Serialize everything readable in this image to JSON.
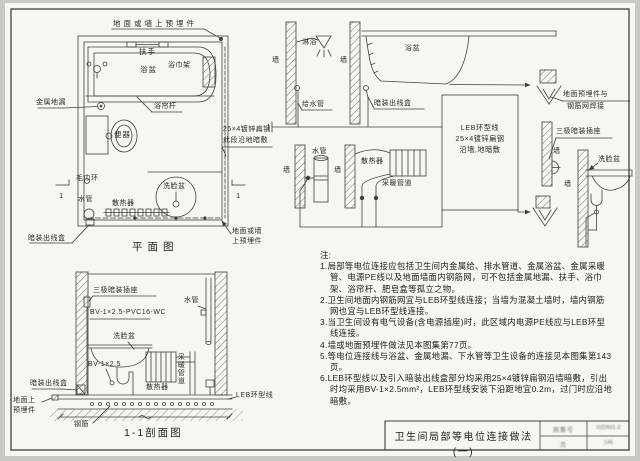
{
  "page": {
    "background": "#c9c9c7",
    "paper": "#f7f6f2",
    "line_color": "#41403b"
  },
  "plan": {
    "title": "平面图",
    "labels": {
      "embed_top": "地面或墙上预埋件",
      "handrail": "扶手",
      "tub": "浴盆",
      "towel_rack": "浴巾架",
      "floor_drain": "金属地漏",
      "curtain_rod": "浴帘杆",
      "toilet": "便器",
      "flat_steel_line1": "25×4镀锌扁钢",
      "flat_steel_line2": "此段沿地暗敷",
      "towel_ring": "毛巾环",
      "basin": "洗脸盆",
      "water_pipe": "水管",
      "radiator": "散热器",
      "outlet_box": "暗装出线盒",
      "embed_bottom_line1": "地面或墙",
      "embed_bottom_line2": "上预埋件",
      "cut_mark": "1"
    }
  },
  "section": {
    "title": "1-1剖面图",
    "labels": {
      "socket": "三极暗装插座",
      "wire_spec": "BV-1×2.5-PVC16-WC",
      "water_pipe": "水管",
      "basin": "洗脸盆",
      "wire": "BV-1×2.5",
      "radiator": "散热器",
      "heating_pipe": "采暖管道",
      "outlet_box": "暗装出线盒",
      "floor_embed_line1": "地面上",
      "floor_embed_line2": "预埋件",
      "rebar": "钢筋",
      "leb_ring": "LEB环型线"
    }
  },
  "details": {
    "wall": "墙",
    "shower": "淋浴",
    "supply_pipe": "给水管",
    "tub": "浴盆",
    "outlet_box": "暗装出线盒",
    "water_pipe": "水管",
    "radiator": "散热器",
    "heating_pipe": "采暖管道",
    "leb_box_line1": "LEB环型线",
    "leb_box_line2": "25×4镀锌扁钢",
    "leb_box_line3": "沿墙,地暗敷",
    "embed_weld_line1": "地面预埋件与",
    "embed_weld_line2": "钢筋网焊接",
    "socket": "三极暗装插座",
    "basin": "洗脸盆"
  },
  "notes": {
    "title": "注:",
    "items": [
      "1.局部等电位连接应包括卫生间内金属给、排水管道、金属浴盆、金属采暖管、电源PE线以及地面墙面内钢筋网，可不包括金属地漏、扶手、浴巾架、浴帘杆、肥皂盒等孤立之物。",
      "2.卫生间地面内钢筋网宜与LEB环型线连接；当墙为混凝土墙时，墙内钢筋网也宜与LEB环型线连接。",
      "3.当卫生间设有电气设备(含电源插座)时，此区域内电源PE线应与LEB环型线连接。",
      "4.墙或地面预埋件做法见本图集第77页。",
      "5.等电位连接线与浴盆、金属地漏、下水管等卫生设备的连接见本图集第143页。",
      "6.LEB环型线以及引入暗装出线盒部分均采用25×4镀锌扁钢沿墙暗敷，引出时均采用BV-1×2.5mm²，LEB环型线安装下沿距地宜0.2m，过门时应沿地暗敷。"
    ]
  },
  "title_block": {
    "title": "卫生间局部等电位连接做法(一)",
    "atlas_label": "图集号",
    "atlas_value": "02D501-2",
    "page_label": "页",
    "page_value": "145"
  }
}
